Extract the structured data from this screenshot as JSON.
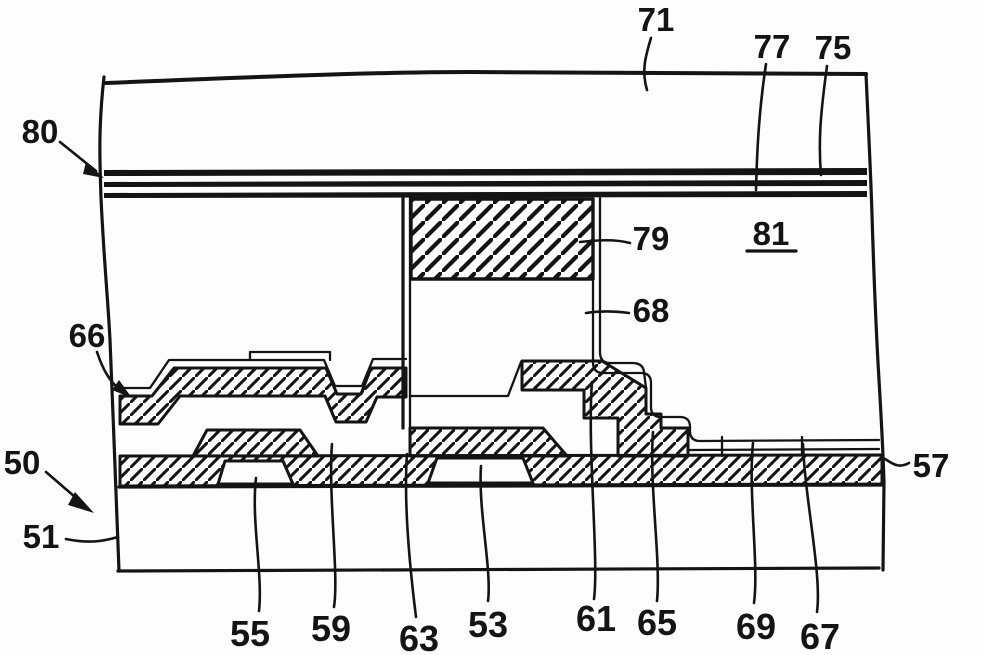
{
  "figure": {
    "background": "#fdfdfd",
    "line_color": "#141414",
    "description_visible_text_only": true
  },
  "labels": {
    "l71": "71",
    "l77": "77",
    "l75": "75",
    "l80": "80",
    "l81": "81",
    "l79": "79",
    "l68": "68",
    "l66": "66",
    "l50": "50",
    "l51": "51",
    "l57": "57",
    "l55": "55",
    "l59": "59",
    "l63": "63",
    "l53": "53",
    "l61": "61",
    "l65": "65",
    "l69": "69",
    "l67": "67"
  }
}
